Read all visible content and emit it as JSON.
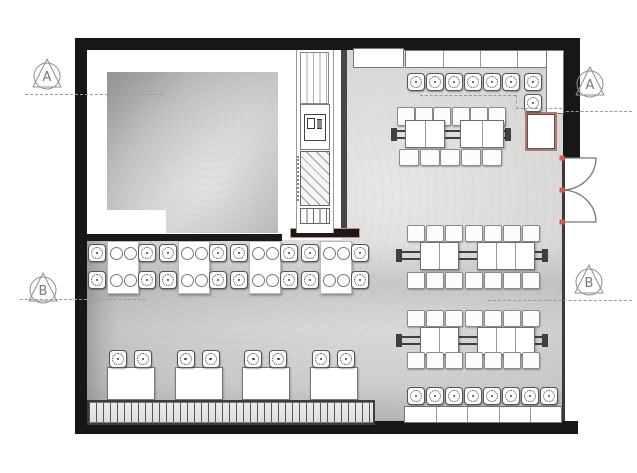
{
  "plan": {
    "title": "restaurant-floor-plan",
    "markers": [
      {
        "label": "A",
        "position": "left-top"
      },
      {
        "label": "B",
        "position": "left-bottom"
      },
      {
        "label": "A",
        "position": "right-top"
      },
      {
        "label": "B",
        "position": "right-bottom"
      }
    ],
    "section_lines": [
      {
        "x": 25,
        "y": 94,
        "len": 138,
        "dir": "h"
      },
      {
        "x": 420,
        "y": 95,
        "len": 96,
        "dir": "h"
      },
      {
        "x": 516,
        "y": 95,
        "len": 14,
        "dir": "v"
      },
      {
        "x": 516,
        "y": 108,
        "len": 46,
        "dir": "h"
      },
      {
        "x": 566,
        "y": 111,
        "len": 66,
        "dir": "h"
      },
      {
        "x": 20,
        "y": 299,
        "len": 126,
        "dir": "h"
      },
      {
        "x": 488,
        "y": 300,
        "len": 144,
        "dir": "h"
      }
    ],
    "colors": {
      "wall": "#171717",
      "floor_light": "#e8e7e5",
      "floor_dark": "#b7b6b4",
      "line_gray": "#8f8f8f",
      "door_hinge_red": "#e0564a",
      "high_table_border": "#b5786c",
      "kitchen_bar_outline": "#cd8d7f"
    },
    "furniture": {
      "stool_rows": [
        {
          "name": "bar-stool-row-top",
          "x": 407,
          "y": 73,
          "count": 6,
          "step": 19,
          "size": 16,
          "dir": "h"
        },
        {
          "name": "bar-stool-pair-corner",
          "x": 524,
          "y": 73,
          "count": 2,
          "step": 21,
          "size": 16,
          "dir": "v"
        },
        {
          "name": "bar-stool-row-bottom",
          "x": 407,
          "y": 387,
          "count": 8,
          "step": 19,
          "size": 16,
          "dir": "h"
        }
      ],
      "mid_left_tables": {
        "count": 4,
        "x0": 107,
        "step": 71,
        "table": {
          "y": 241,
          "w": 30,
          "h": 51
        },
        "plates": {
          "left": [
            2,
            16
          ],
          "top": [
            5,
            32
          ],
          "d": 11
        },
        "stools": {
          "size": 16,
          "dx": [
            -19,
            31
          ],
          "rows": [
            3,
            30
          ]
        }
      },
      "bottom_left_tables": {
        "count": 4,
        "x0": 107,
        "step": 67.7,
        "table": {
          "y": 367,
          "w": 46,
          "h": 31
        },
        "stools": {
          "y": 350,
          "size": 16,
          "dx": [
            2,
            27
          ]
        }
      },
      "top_right_group": {
        "chair_top": {
          "x": 397,
          "y": 107,
          "n": 6,
          "step": 18.2,
          "w": 16,
          "h": 17
        },
        "rail": {
          "x": 396,
          "y": 130,
          "w": 110
        },
        "tables": [
          {
            "x": 405,
            "y": 120,
            "w": 38,
            "h": 26,
            "cells": 2
          },
          {
            "x": 460,
            "y": 120,
            "w": 42,
            "h": 26,
            "cells": 2
          }
        ],
        "chair_bot": {
          "x": 399,
          "y": 149,
          "n": 5,
          "step": 20.7,
          "w": 18,
          "h": 15
        }
      },
      "right_groups": [
        {
          "chair_top": {
            "x": 407,
            "y": 225,
            "n": 7,
            "step": 19.2,
            "w": 16,
            "h": 15
          },
          "rail": {
            "x": 401,
            "y": 251,
            "w": 142
          },
          "tables": [
            {
              "x": 420,
              "y": 242,
              "w": 37,
              "h": 26,
              "cells": 2
            },
            {
              "x": 477,
              "y": 242,
              "w": 56,
              "h": 26,
              "cells": 3
            }
          ],
          "chair_bot": {
            "x": 407,
            "y": 272,
            "n": 7,
            "step": 19.2,
            "w": 16,
            "h": 15
          }
        },
        {
          "chair_top": {
            "x": 407,
            "y": 310,
            "n": 7,
            "step": 19.2,
            "w": 16,
            "h": 15
          },
          "rail": {
            "x": 401,
            "y": 336,
            "w": 142
          },
          "tables": [
            {
              "x": 420,
              "y": 327,
              "w": 37,
              "h": 26,
              "cells": 2
            },
            {
              "x": 477,
              "y": 327,
              "w": 56,
              "h": 26,
              "cells": 3
            }
          ],
          "chair_bot": {
            "x": 407,
            "y": 352,
            "n": 7,
            "step": 19.2,
            "w": 16,
            "h": 15
          }
        }
      ],
      "counters": [
        {
          "name": "top-counter-block",
          "x": 353,
          "y": 48,
          "w": 49,
          "h": 18,
          "dividers": 0
        },
        {
          "name": "top-counter",
          "x": 405,
          "y": 50,
          "w": 148,
          "h": 16,
          "dividers": 3
        },
        {
          "name": "corner-counter",
          "x": 546,
          "y": 50,
          "w": 16,
          "h": 62,
          "dividers": 0
        },
        {
          "name": "bottom-counter",
          "x": 404,
          "y": 406,
          "w": 156,
          "h": 15,
          "dividers": 4
        }
      ],
      "high_table": {
        "x": 525,
        "y": 112,
        "w": 28,
        "h": 35
      },
      "bench": {
        "x": 87,
        "y": 400,
        "w": 284,
        "h": 21
      }
    }
  }
}
